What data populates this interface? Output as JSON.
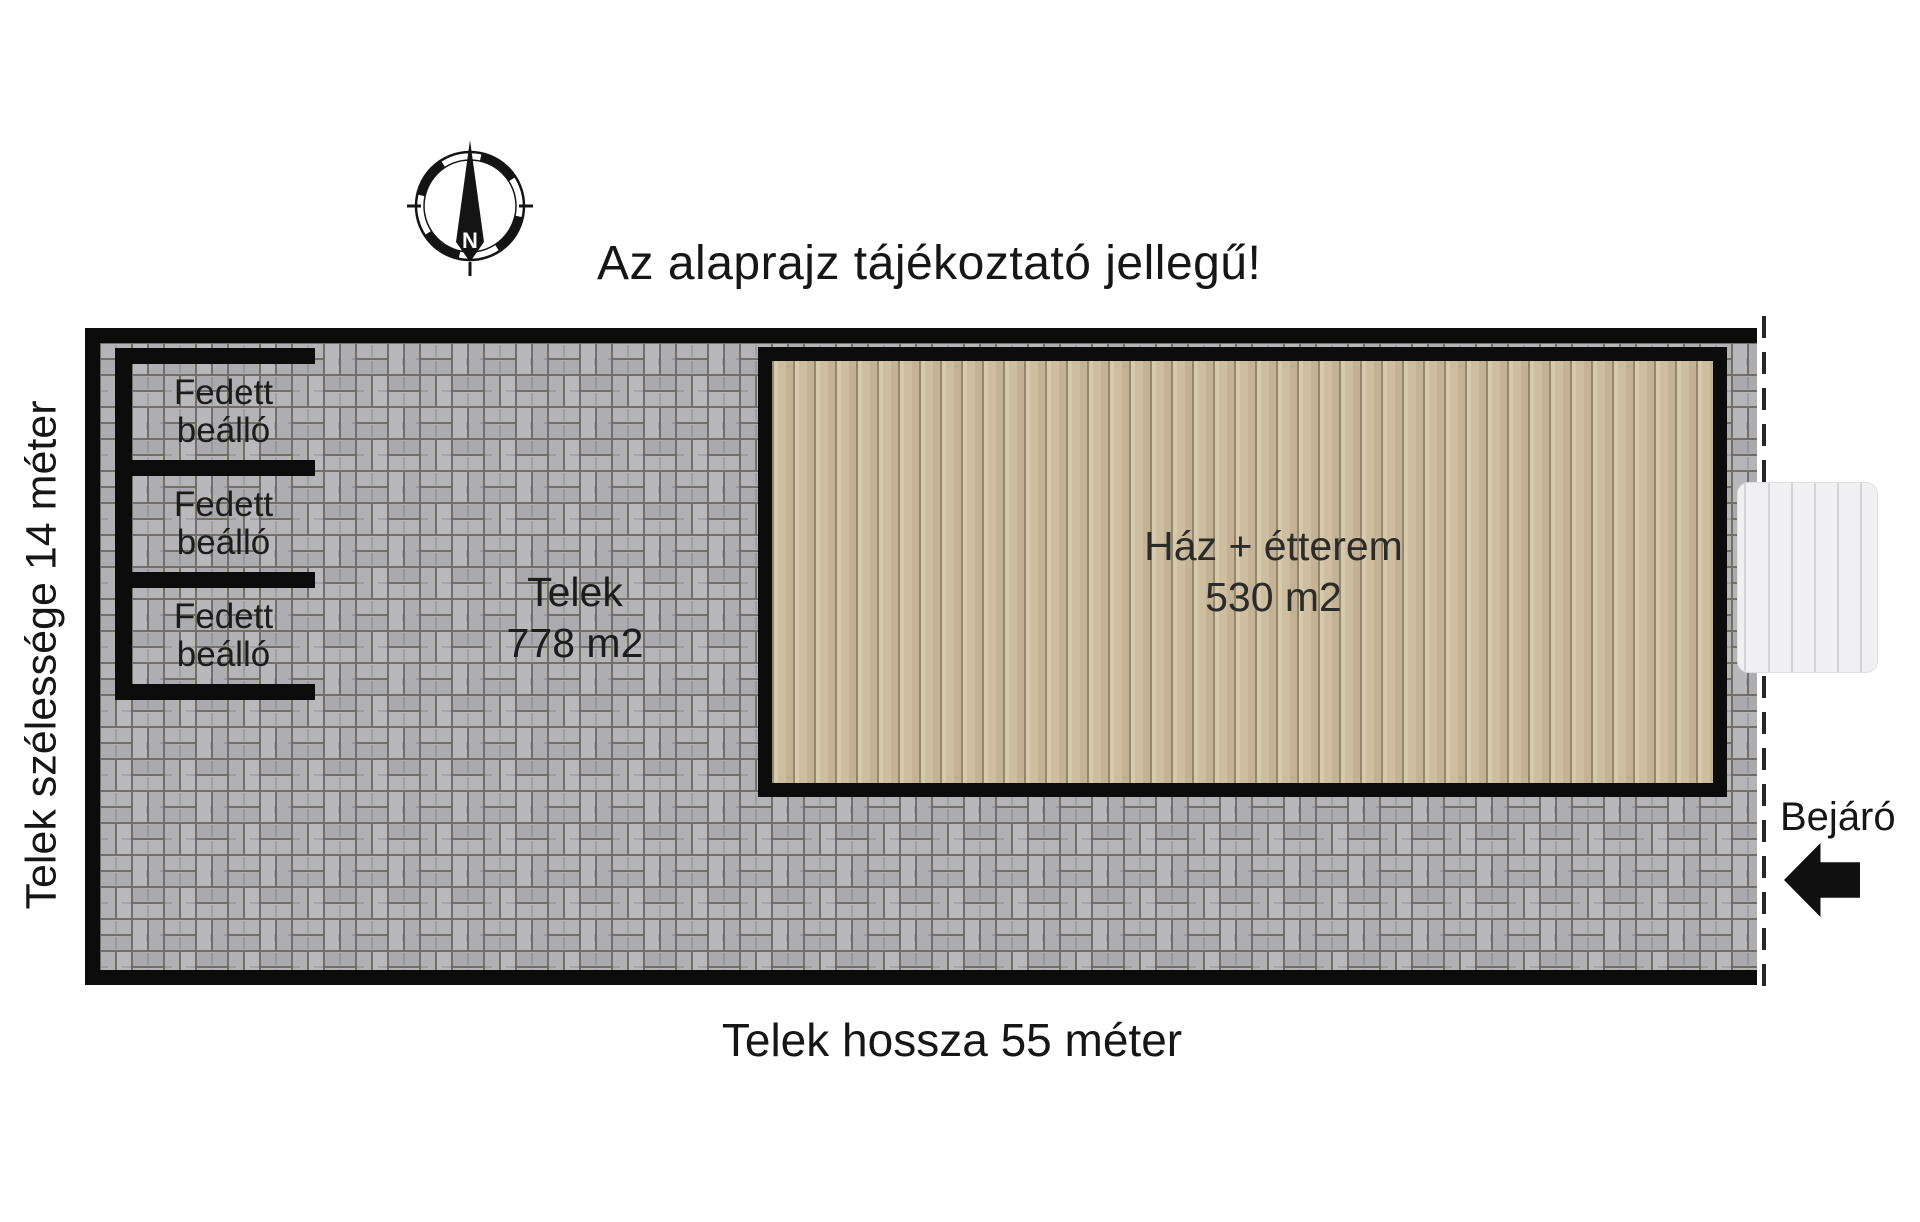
{
  "title": "Az alaprajz tájékoztató jellegű!",
  "compass": {
    "north_label": "N"
  },
  "plot": {
    "name": "Telek",
    "area": "778 m2",
    "width_label": "Telek szélessége 14 méter",
    "length_label": "Telek hossza 55 méter"
  },
  "carports": [
    {
      "line1": "Fedett",
      "line2": "beálló"
    },
    {
      "line1": "Fedett",
      "line2": "beálló"
    },
    {
      "line1": "Fedett",
      "line2": "beálló"
    }
  ],
  "building": {
    "name": "Ház + étterem",
    "area": "530 m2"
  },
  "entrance": {
    "label": "Bejáró"
  },
  "colors": {
    "wall_black": "#0c0c0c",
    "paving_brick": "#b4b3b8",
    "paving_joint": "#72715f",
    "building_fill": "#cdbe9f",
    "building_seam": "#93876c",
    "stairs_fill": "#f0f0f2",
    "text": "#1b1b1b"
  }
}
